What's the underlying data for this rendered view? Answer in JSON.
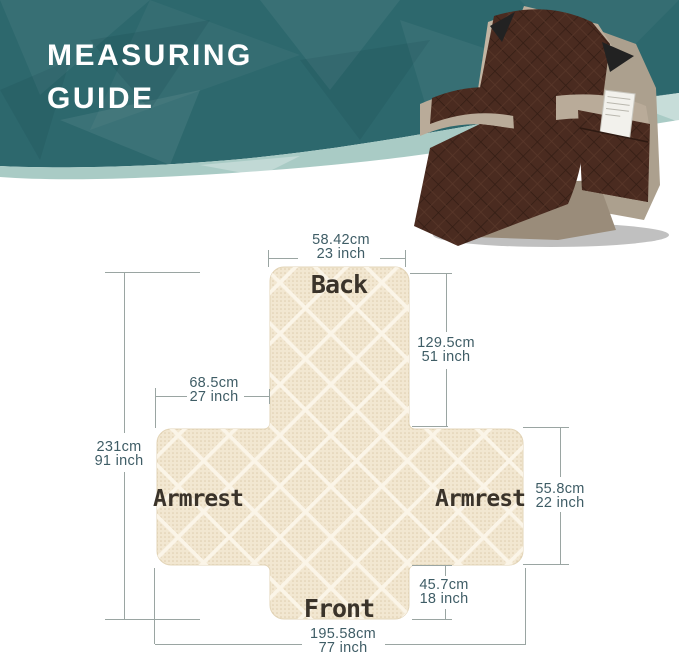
{
  "banner": {
    "title": [
      "MEASURING",
      "GUIDE"
    ],
    "background_color": "#2d686d",
    "ribbon_color": "#a9cbc5",
    "text_color": "#ffffff"
  },
  "hero_chair": {
    "cover_color": "#4a2b20",
    "chair_body_color": "#b9ab99"
  },
  "diagram": {
    "fabric_color": "#f2e7d1",
    "line_color": "#9aa5a2",
    "text_color": "#3f5d66",
    "labels": {
      "back": "Back",
      "armrest_left": "Armrest",
      "armrest_right": "Armrest",
      "front": "Front"
    },
    "dimensions": {
      "top_width": {
        "cm": "58.42cm",
        "inch": "23 inch"
      },
      "back_length": {
        "cm": "129.5cm",
        "inch": "51 inch"
      },
      "armrest_width": {
        "cm": "68.5cm",
        "inch": "27 inch"
      },
      "total_length": {
        "cm": "231cm",
        "inch": "91 inch"
      },
      "armrest_height": {
        "cm": "55.8cm",
        "inch": "22 inch"
      },
      "front_height": {
        "cm": "45.7cm",
        "inch": "18 inch"
      },
      "total_width": {
        "cm": "195.58cm",
        "inch": "77 inch"
      }
    }
  }
}
